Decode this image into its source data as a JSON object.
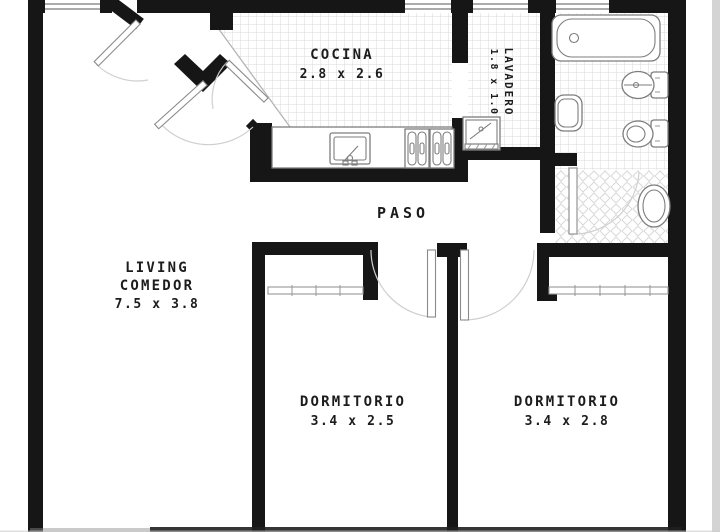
{
  "plan": {
    "type": "apartment floor plan",
    "style": "black-and-white architectural drawing"
  },
  "rooms": {
    "cocina": {
      "name": "COCINA",
      "dims": "2.8 x 2.6"
    },
    "lavadero": {
      "name": "LAVADERO",
      "dims": "1.8 x 1.0"
    },
    "paso": {
      "name": "PASO"
    },
    "living": {
      "line1": "LIVING",
      "line2": "COMEDOR",
      "dims": "7.5 x 3.8"
    },
    "dormitorio1": {
      "name": "DORMITORIO",
      "dims": "3.4 x 2.5"
    },
    "dormitorio2": {
      "name": "DORMITORIO",
      "dims": "3.4 x 2.8"
    }
  },
  "fixtures": [
    "bathtub",
    "bidet",
    "toilet",
    "washbasin",
    "oval-basin",
    "laundry-tub",
    "kitchen-counter",
    "kitchen-sink",
    "cooktop",
    "refrigerator"
  ],
  "colors": {
    "wall": "#161616",
    "paper": "#ffffff",
    "tile_line": "#d9d9d9",
    "door_arc": "#cfcfcf",
    "label": "#1c1c1c",
    "edge_strip": "#d4d4d4",
    "fixture_line": "#7d7d7d"
  }
}
